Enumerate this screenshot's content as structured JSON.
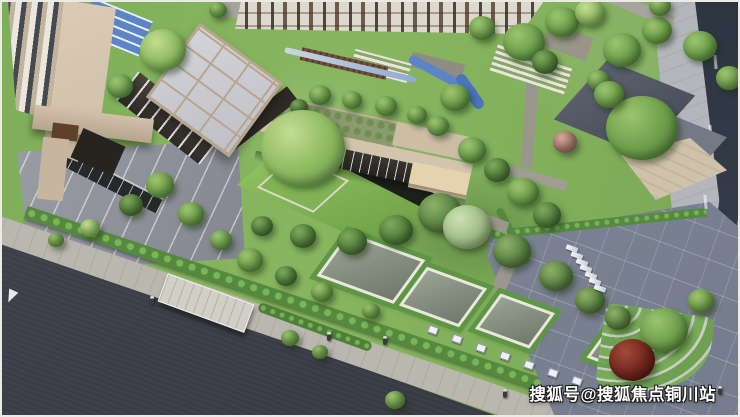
{
  "image": {
    "kind": "aerial 3D architectural rendering",
    "description": "Bird's-eye rendering of a residential community entrance landscape: beige high-rise tower, glass-grid-roof clubhouse pavilion, low clubhouse wing with roof garden, central lawn courtyard with black reflecting pool, blue stream, drop-off plaza, diagonal asphalt road with promenade hedge and skylight pools, gray plaza with parked bikes, gray-roof annex building, curved terraced garden with red maple."
  },
  "watermark": {
    "text": "搜狐号@搜狐焦点铜川站"
  },
  "palette": {
    "lawn": "#7fae5a",
    "hedge": "#55893f",
    "road_asphalt": "#3a3d47",
    "sidewalk": "#bab7af",
    "plaza": "#7d8494",
    "water": "#5d84c4",
    "black_pool": "#1b201b",
    "skylight_glass": "#6f7a6c",
    "skylight_frame": "#e9e7de",
    "building_beige": "#c9b8a2",
    "roof_glass": "#bfc0c6",
    "roof_frame": "#b7a68d",
    "gray_roof": "#454b57",
    "tan_court": "#cfc2ab",
    "maple_red": "#6e241c"
  },
  "scene": {
    "trees": [
      [
        163,
        50,
        23,
        "light"
      ],
      [
        120,
        86,
        13,
        "mid"
      ],
      [
        218,
        10,
        9,
        "mid"
      ],
      [
        524,
        42,
        21,
        "mid"
      ],
      [
        562,
        22,
        17,
        "mid"
      ],
      [
        482,
        28,
        13,
        "mid"
      ],
      [
        590,
        12,
        15,
        "light"
      ],
      [
        622,
        50,
        19,
        "mid"
      ],
      [
        657,
        30,
        15,
        "mid"
      ],
      [
        700,
        46,
        17,
        "mid"
      ],
      [
        729,
        78,
        13,
        "mid"
      ],
      [
        545,
        62,
        13,
        "dark"
      ],
      [
        598,
        80,
        11,
        "mid"
      ],
      [
        660,
        6,
        11,
        "mid"
      ],
      [
        320,
        95,
        11,
        "mid"
      ],
      [
        352,
        100,
        10,
        "mid"
      ],
      [
        386,
        106,
        11,
        "mid"
      ],
      [
        417,
        115,
        10,
        "mid"
      ],
      [
        299,
        107,
        9,
        "dark"
      ],
      [
        438,
        126,
        11,
        "mid"
      ],
      [
        303,
        148,
        42,
        "light"
      ],
      [
        565,
        142,
        12,
        "pink"
      ],
      [
        642,
        128,
        36,
        "mid"
      ],
      [
        609,
        94,
        15,
        "mid"
      ],
      [
        455,
        97,
        15,
        "mid"
      ],
      [
        472,
        150,
        14,
        "mid"
      ],
      [
        497,
        170,
        13,
        "dark"
      ],
      [
        523,
        192,
        16,
        "mid"
      ],
      [
        547,
        215,
        14,
        "dark"
      ],
      [
        440,
        213,
        22,
        "pine"
      ],
      [
        467,
        227,
        24,
        "pinelight"
      ],
      [
        396,
        230,
        17,
        "dark"
      ],
      [
        352,
        241,
        15,
        "dark"
      ],
      [
        303,
        236,
        13,
        "dark"
      ],
      [
        262,
        226,
        11,
        "dark"
      ],
      [
        512,
        251,
        19,
        "pine"
      ],
      [
        556,
        276,
        17,
        "pine"
      ],
      [
        590,
        300,
        15,
        "pine"
      ],
      [
        618,
        318,
        13,
        "pine"
      ],
      [
        664,
        330,
        24,
        "mid"
      ],
      [
        701,
        301,
        13,
        "mid"
      ],
      [
        632,
        360,
        23,
        "red"
      ],
      [
        160,
        185,
        14,
        "mid"
      ],
      [
        131,
        205,
        12,
        "dark"
      ],
      [
        191,
        214,
        13,
        "mid"
      ],
      [
        221,
        240,
        11,
        "mid"
      ],
      [
        90,
        228,
        10,
        "light"
      ],
      [
        56,
        240,
        8,
        "mid"
      ],
      [
        250,
        260,
        13,
        "mid"
      ],
      [
        286,
        276,
        11,
        "dark"
      ],
      [
        322,
        292,
        11,
        "mid"
      ],
      [
        371,
        311,
        9,
        "mid"
      ],
      [
        290,
        338,
        9,
        "mid"
      ],
      [
        320,
        352,
        8,
        "mid"
      ],
      [
        395,
        400,
        10,
        "mid"
      ]
    ],
    "skylight_pools": [
      {
        "x": 368,
        "y": 265,
        "w": 76,
        "h": 46
      },
      {
        "x": 440,
        "y": 294,
        "w": 58,
        "h": 40
      },
      {
        "x": 512,
        "y": 318,
        "w": 52,
        "h": 36
      },
      {
        "x": 622,
        "y": 344,
        "w": 46,
        "h": 40
      }
    ],
    "vehicles": [
      [
        566,
        246
      ],
      [
        571,
        253
      ],
      [
        576,
        260
      ],
      [
        580,
        266
      ],
      [
        585,
        273
      ],
      [
        589,
        279
      ],
      [
        594,
        286
      ]
    ],
    "light_panels": [
      [
        428,
        326
      ],
      [
        452,
        335
      ],
      [
        476,
        344
      ],
      [
        500,
        352
      ],
      [
        524,
        361
      ],
      [
        548,
        369
      ],
      [
        572,
        377
      ]
    ],
    "people": [
      [
        150,
        296
      ],
      [
        327,
        332
      ],
      [
        383,
        336
      ],
      [
        718,
        386
      ],
      [
        503,
        389
      ]
    ]
  }
}
